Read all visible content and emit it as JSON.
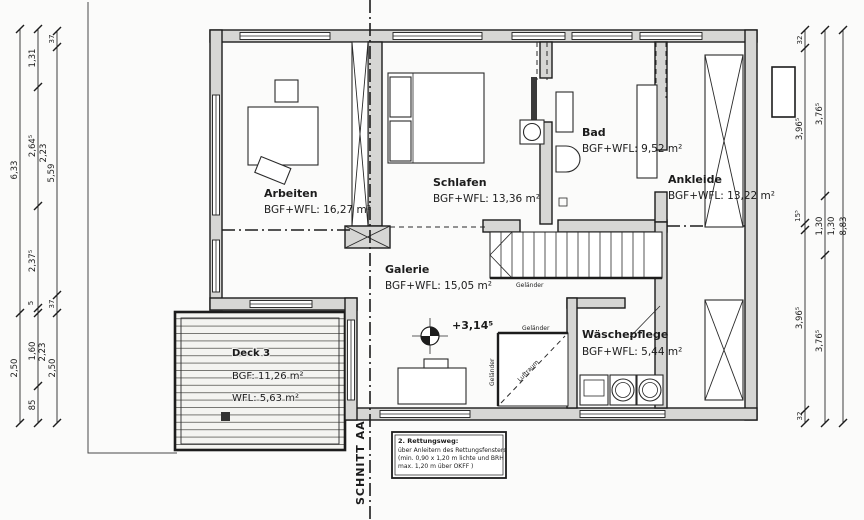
{
  "rooms": {
    "arbeiten": {
      "name": "Arbeiten",
      "area": "BGF+WFL: 16,27 m²"
    },
    "schlafen": {
      "name": "Schlafen",
      "area": "BGF+WFL: 13,36 m²"
    },
    "bad": {
      "name": "Bad",
      "area": "BGF+WFL: 9,52 m²"
    },
    "ankleide": {
      "name": "Ankleide",
      "area": "BGF+WFL: 13,22 m²"
    },
    "galerie": {
      "name": "Galerie",
      "area": "BGF+WFL: 15,05 m²"
    },
    "waeschepflege": {
      "name": "Wäschepflege",
      "area": "BGF+WFL: 5,44 m²"
    },
    "deck": {
      "name": "Deck 3",
      "bgf": "BGF: 11,26 m²",
      "wfl": "WFL: 5,63 m²"
    }
  },
  "annotations": {
    "level": "+3,14⁵",
    "section": "SCHNITT AA",
    "railing": "Geländer",
    "airspace": "Luftraum",
    "note_title": "2. Rettungsweg:",
    "note_line1": "über Anleitern des Rettungsfensters",
    "note_line2": "(min. 0,90 x 1,20 m lichte und BRH",
    "note_line3": "max. 1,20 m über OKFF )"
  },
  "dims": {
    "l1_a": "6,33",
    "l1_b": "2,50",
    "l2_a": "1,31",
    "l2_b": "2,64⁵",
    "l2_c": "2,37⁵",
    "l2_d": "5",
    "l2_e": "1,60",
    "l2_f": "85",
    "l3_a": "37",
    "l3_b": "2,23",
    "l3_c": "5,59",
    "l3_d": "37",
    "l3_e": "2,23",
    "l3_f": "2,50",
    "r1_a": "32",
    "r1_b": "3,96⁵",
    "r1_c": "15⁵",
    "r1_d": "3,96⁵",
    "r1_e": "32",
    "r2_a": "3,76⁵",
    "r2_b": "1,30",
    "r2_c": "3,76⁵",
    "r3_a": "1,30",
    "r3_b": "8,83"
  }
}
